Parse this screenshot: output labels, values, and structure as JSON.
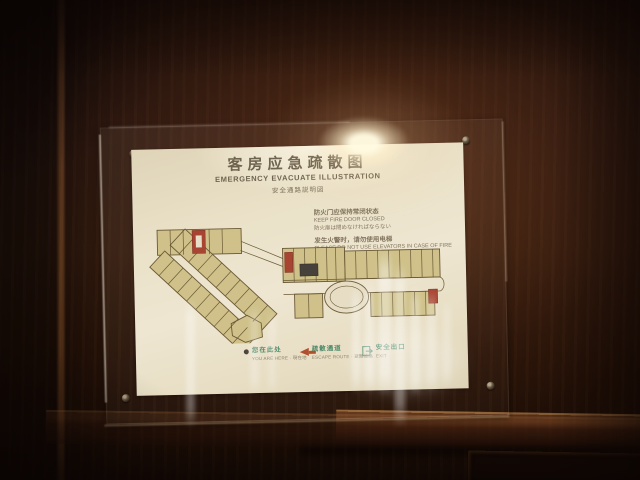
{
  "sign": {
    "title_cn": "客房应急疏散图",
    "title_en": "EMERGENCY EVACUATE ILLUSTRATION",
    "title_jp": "安全通路説明図",
    "notices": [
      {
        "cn": "防火门应保持常闭状态",
        "en": "KEEP FIRE DOOR CLOSED",
        "jp": "防火扉は閉めなければならない"
      },
      {
        "cn": "发生火警时，请勿使用电梯",
        "en": "PLEASE DO NOT USE ELEVATORS IN CASE OF FIRE",
        "jp": "火災が発生したとき、エレベーターは使用禁止"
      }
    ],
    "phone_line": {
      "cn": "报警电话 4000",
      "en": "FIRE 4000",
      "jp": "火災電話 4000"
    },
    "legend": {
      "items": [
        {
          "icon": "location-dot-icon",
          "label": "您在此处",
          "sub": "YOU ARE HERE · 現在地"
        },
        {
          "icon": "escape-route-arrow-icon",
          "label": "疏散通道",
          "sub": "ESCAPE ROUTE · 避難通路"
        },
        {
          "icon": "exit-icon",
          "label": "安全出口",
          "sub": "EXIT"
        }
      ]
    },
    "colors": {
      "accent_red": "#a84532",
      "legend_green": "#4d8a68",
      "room_fill": "#cfc189",
      "plan_line": "#6a5936",
      "paper": "#ebe2ca",
      "wood": "#2c1710"
    }
  }
}
